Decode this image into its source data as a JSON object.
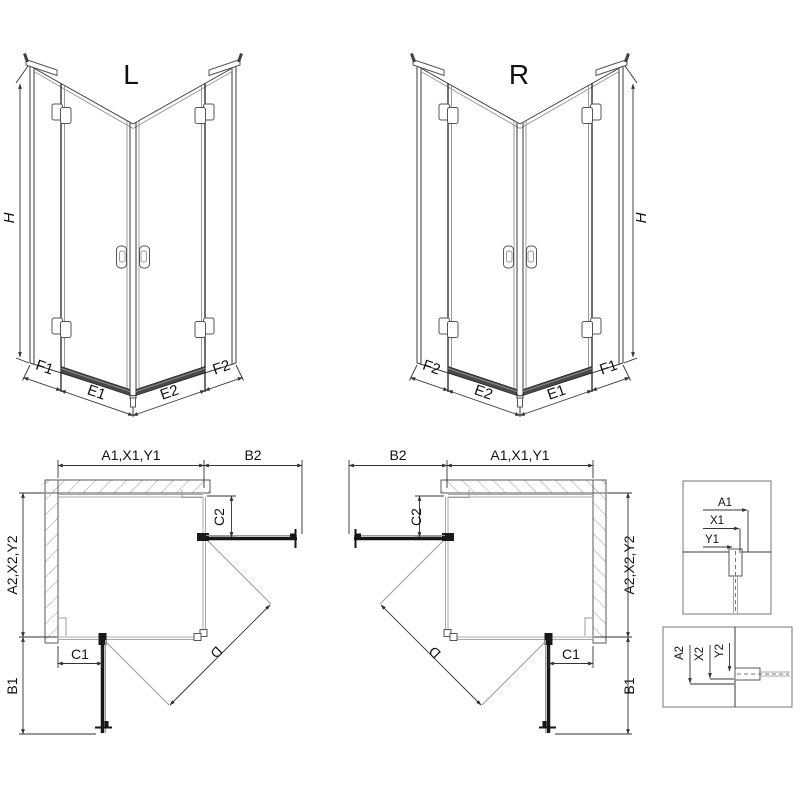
{
  "drawing": {
    "type": "shower-enclosure-technical-diagram",
    "views": {
      "iso_left": {
        "title": "L"
      },
      "iso_right": {
        "title": "R"
      }
    },
    "labels": {
      "height": "H",
      "f1": "F1",
      "e1": "E1",
      "e2": "E2",
      "f2": "F2",
      "width_top": "A1,X1,Y1",
      "depth_side": "A2,X2,Y2",
      "b1": "B1",
      "b2": "B2",
      "c1": "C1",
      "c2": "C2",
      "diagonal": "D",
      "detail_a1": "A1",
      "detail_x1": "X1",
      "detail_y1": "Y1",
      "detail_a2": "A2",
      "detail_x2": "X2",
      "detail_y2": "Y2"
    },
    "colors": {
      "line": "#3a3a3a",
      "glass": "#a9a9a9",
      "hatch": "#9a9a9a",
      "panel_dark": "#161616",
      "threshold": "#4a4a4a",
      "background": "#ffffff"
    }
  }
}
